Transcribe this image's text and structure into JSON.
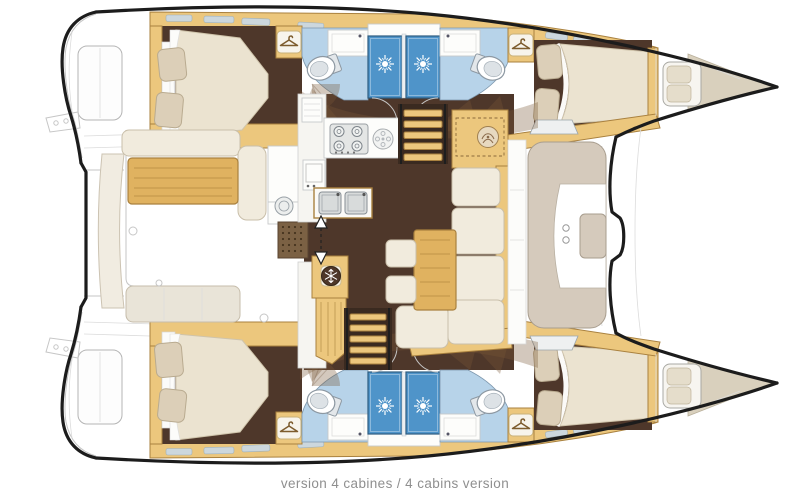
{
  "caption": {
    "text": "version 4 cabines / 4 cabins version"
  },
  "colors": {
    "outline": "#1c1c1c",
    "wood": "#ecc77d",
    "wood_dark": "#e0b260",
    "wood_edge": "#a9813f",
    "floor": "#4e372a",
    "floor_dark": "#3a2a20",
    "cream": "#f1ebdd",
    "cream_edge": "#c9bfaa",
    "mattress": "#ebe3d0",
    "mattress_edge": "#cfc4ab",
    "pillow": "#dccfb8",
    "pillow_edge": "#b9ab90",
    "bath": "#b7d3e9",
    "bath_edge": "#7d97ad",
    "shower": "#4f94c9",
    "shower_edge": "#2d5c80",
    "taupe": "#d5cabc",
    "taupe_edge": "#a89d8e",
    "deck": "#d9d0bd",
    "overlay": "rgba(122,88,55,0.33)",
    "caption": "#8f8f8f",
    "counter": "#fdfdfb"
  },
  "icons": {
    "wardrobe": "hanger-icon",
    "shower": "sunburst-icon",
    "refrigerator": "snowflake-icon",
    "stove": "four-burner-icon",
    "sinks": "double-sink-icon",
    "toilet": "toilet-icon",
    "sliding_door": "double-arrow-icon",
    "nav_instrument": "dial-icon"
  }
}
